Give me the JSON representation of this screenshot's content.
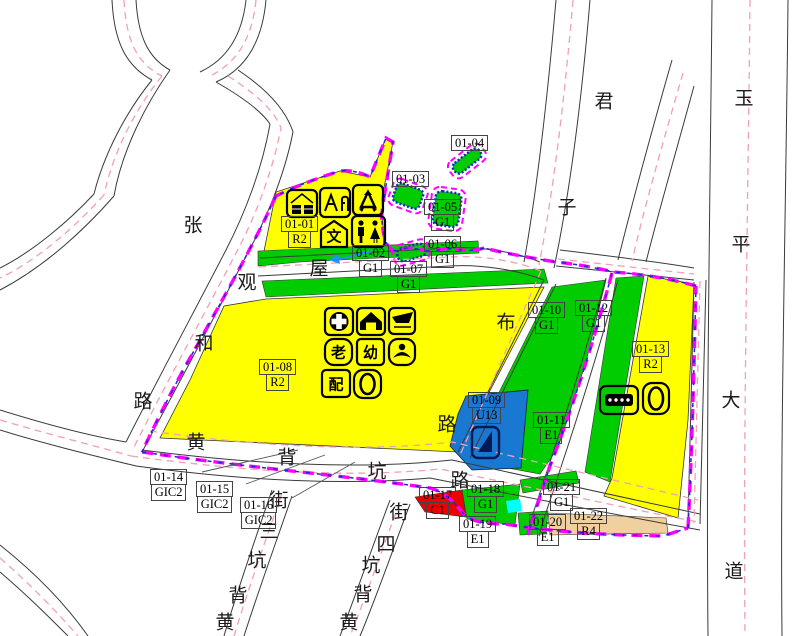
{
  "map_title": "zoning-plan-sheet",
  "colors": {
    "r2": "#FFFF00",
    "g1": "#00CC00",
    "u13": "#1878D2",
    "c1": "#EE0000",
    "r4": "#F0D09E",
    "cyan": "#00FFFF",
    "bnd": "#FF00FF",
    "bndb": "#2222DD",
    "pink": "#F2A0B4",
    "edge": "#3a3a3a",
    "txt": "#000000"
  },
  "parcel_labels": [
    {
      "id": "01-01",
      "code": "R2",
      "x": 281,
      "y": 216
    },
    {
      "id": "01-02",
      "code": "G1",
      "x": 352,
      "y": 245
    },
    {
      "id": "01-03",
      "code": "",
      "x": 392,
      "y": 171
    },
    {
      "id": "01-04",
      "code": "",
      "x": 451,
      "y": 135
    },
    {
      "id": "01-05",
      "code": "G1",
      "x": 424,
      "y": 199
    },
    {
      "id": "01-06",
      "code": "G1",
      "x": 424,
      "y": 236
    },
    {
      "id": "01-07",
      "code": "G1",
      "x": 390,
      "y": 261
    },
    {
      "id": "01-08",
      "code": "R2",
      "x": 259,
      "y": 359
    },
    {
      "id": "01-09",
      "code": "U13",
      "x": 468,
      "y": 392
    },
    {
      "id": "01-10",
      "code": "G1",
      "x": 528,
      "y": 302
    },
    {
      "id": "01-11",
      "code": "E1",
      "x": 533,
      "y": 412
    },
    {
      "id": "01-12",
      "code": "G1",
      "x": 575,
      "y": 300
    },
    {
      "id": "01-13",
      "code": "R2",
      "x": 632,
      "y": 341
    },
    {
      "id": "01-14",
      "code": "GIC2",
      "x": 150,
      "y": 469
    },
    {
      "id": "01-15",
      "code": "GIC2",
      "x": 196,
      "y": 481
    },
    {
      "id": "01-16",
      "code": "GIC2",
      "x": 240,
      "y": 497
    },
    {
      "id": "01-17",
      "code": "C1",
      "x": 419,
      "y": 487
    },
    {
      "id": "01-18",
      "code": "G1",
      "x": 467,
      "y": 481
    },
    {
      "id": "01-19",
      "code": "E1",
      "x": 459,
      "y": 516
    },
    {
      "id": "01-20",
      "code": "E1",
      "x": 529,
      "y": 514
    },
    {
      "id": "01-21",
      "code": "G1",
      "x": 543,
      "y": 479
    },
    {
      "id": "01-22",
      "code": "R4",
      "x": 570,
      "y": 508
    }
  ],
  "road_name_chars": [
    {
      "ch": "张",
      "x": 193,
      "y": 224
    },
    {
      "ch": "观",
      "x": 247,
      "y": 281
    },
    {
      "ch": "和",
      "x": 204,
      "y": 342
    },
    {
      "ch": "路",
      "x": 143,
      "y": 400
    },
    {
      "ch": "屋",
      "x": 319,
      "y": 267
    },
    {
      "ch": "布",
      "x": 506,
      "y": 321
    },
    {
      "ch": "路",
      "x": 447,
      "y": 423
    },
    {
      "ch": "黄",
      "x": 196,
      "y": 441
    },
    {
      "ch": "背",
      "x": 287,
      "y": 456
    },
    {
      "ch": "坑",
      "x": 377,
      "y": 470
    },
    {
      "ch": "路",
      "x": 460,
      "y": 479
    },
    {
      "ch": "君",
      "x": 604,
      "y": 100
    },
    {
      "ch": "子",
      "x": 567,
      "y": 206
    },
    {
      "ch": "玉",
      "x": 744,
      "y": 97
    },
    {
      "ch": "平",
      "x": 741,
      "y": 243
    },
    {
      "ch": "大",
      "x": 731,
      "y": 399
    },
    {
      "ch": "道",
      "x": 734,
      "y": 570
    },
    {
      "ch": "街",
      "x": 279,
      "y": 499
    },
    {
      "ch": "三",
      "x": 269,
      "y": 530
    },
    {
      "ch": "坑",
      "x": 257,
      "y": 559
    },
    {
      "ch": "背",
      "x": 238,
      "y": 594
    },
    {
      "ch": "黄",
      "x": 225,
      "y": 621
    },
    {
      "ch": "街",
      "x": 399,
      "y": 511
    },
    {
      "ch": "四",
      "x": 386,
      "y": 543
    },
    {
      "ch": "坑",
      "x": 371,
      "y": 564
    },
    {
      "ch": "背",
      "x": 363,
      "y": 593
    },
    {
      "ch": "黄",
      "x": 349,
      "y": 621
    }
  ],
  "icon_labels": {
    "culture": "文",
    "elderly": "老",
    "kindergarten": "幼",
    "distribution": "配"
  }
}
